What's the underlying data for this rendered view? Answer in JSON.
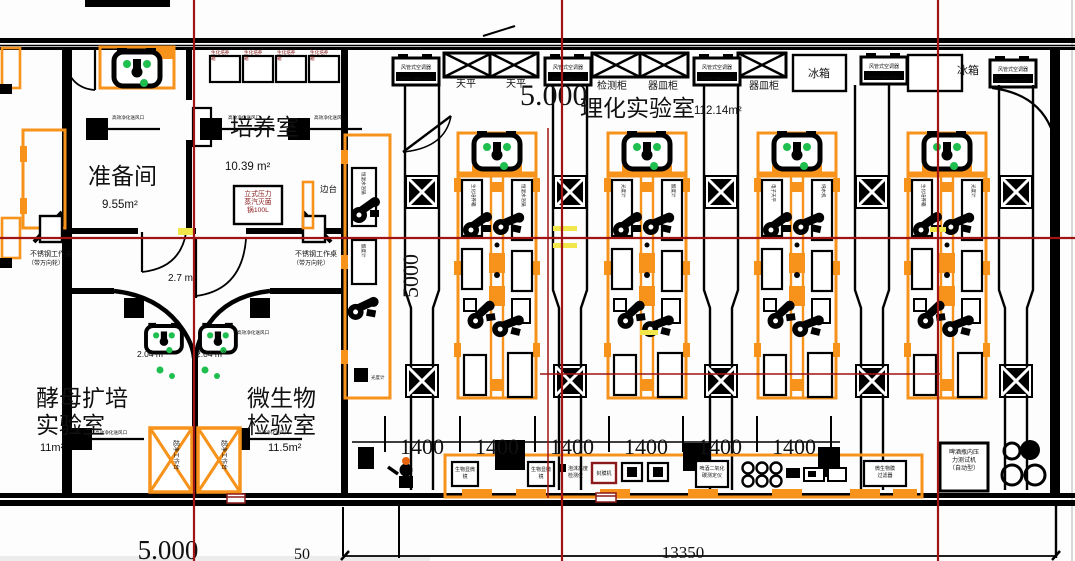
{
  "rooms": {
    "prep": {
      "name": "准备间",
      "area": "9.55m²"
    },
    "culture": {
      "name": "培养室",
      "area": "10.39 m²"
    },
    "physchem": {
      "name": "理化实验室",
      "area": "112.14m²"
    },
    "yeast": {
      "l1": "酵母扩培",
      "l2": "实验室",
      "area": "11m²"
    },
    "micro": {
      "l1": "微生物",
      "l2": "检验室",
      "area": "11.5m²"
    },
    "lobby_left": "2.04 m²",
    "lobby_right": "2.04 m²",
    "corridor": "2.7 m²"
  },
  "levels": {
    "upper": "5.000",
    "lower": "5.000"
  },
  "dims": {
    "bay": "1400",
    "total": "13350",
    "wall": "50",
    "depth": "5000"
  },
  "labels": {
    "vent": "高效净化送风口",
    "incubator": {
      "l1": "生化培养",
      "l2": "箱"
    },
    "ac": {
      "l1": "风管式空调器",
      "l2": "FGR7.5/BJ(Q)U"
    },
    "balance": "天平",
    "test_cabinet": "检测柜",
    "vessel_cabinet": "器皿柜",
    "fridge": "冰箱",
    "autoclave": {
      "l1": "立式压力",
      "l2": "蒸汽灭菌",
      "l3": "锅100L"
    },
    "side_table": "边台",
    "ss_table": {
      "l1": "不锈钢工作桌",
      "l2": "（带万向轮）"
    },
    "clean_bench": "超净工作台",
    "microscope": {
      "l1": "生物显微",
      "l2": "镜"
    },
    "foam": {
      "l1": "泡沫高度",
      "l2": "检测仪"
    },
    "sealer": "封膜机",
    "co2": {
      "l1": "啤酒二氧化",
      "l2": "碳测定仪"
    },
    "membrane": {
      "l1": "微生物膜",
      "l2": "过滤器"
    },
    "pressure": {
      "l1": "啤酒瓶内压",
      "l2": "力测试机",
      "l3": "（自动型）"
    },
    "bench_pool": [
      "生化培养箱",
      "恒温水浴锅",
      "光度计",
      "酸度计",
      "电子天平",
      "纯水机"
    ]
  },
  "colors": {
    "accent_orange": "#F7921B",
    "centerline_red": "#A01414",
    "highlight_yellow": "#F1E64A",
    "status_green": "#1FBF4F"
  }
}
